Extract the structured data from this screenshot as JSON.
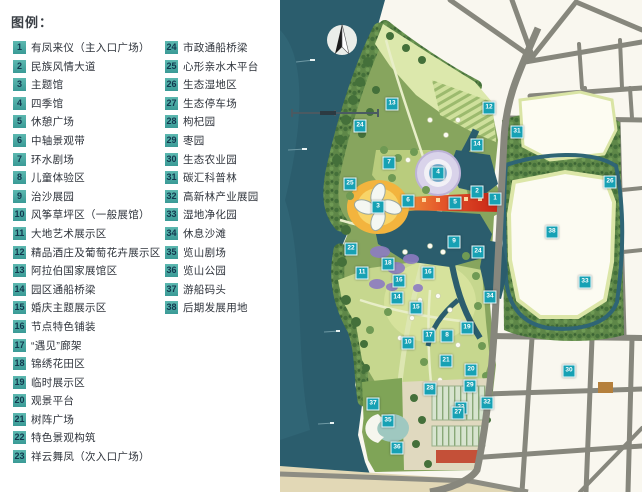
{
  "legend": {
    "title": "图例：",
    "items": [
      {
        "num": "1",
        "label": "有凤来仪（主入口广场）"
      },
      {
        "num": "2",
        "label": "民族风情大道"
      },
      {
        "num": "3",
        "label": "主题馆"
      },
      {
        "num": "4",
        "label": "四季馆"
      },
      {
        "num": "5",
        "label": "休憩广场"
      },
      {
        "num": "6",
        "label": "中轴景观带"
      },
      {
        "num": "7",
        "label": "环水剧场"
      },
      {
        "num": "8",
        "label": "儿童体验区"
      },
      {
        "num": "9",
        "label": "治沙展园"
      },
      {
        "num": "10",
        "label": "风筝草坪区（一般展馆）"
      },
      {
        "num": "11",
        "label": "大地艺术展示区"
      },
      {
        "num": "12",
        "label": "精品酒庄及葡萄花卉展示区"
      },
      {
        "num": "13",
        "label": "阿拉伯国家展馆区"
      },
      {
        "num": "14",
        "label": "园区通船桥梁"
      },
      {
        "num": "15",
        "label": "婚庆主题展示区"
      },
      {
        "num": "16",
        "label": "节点特色铺装"
      },
      {
        "num": "17",
        "label": "“遇见”廊架"
      },
      {
        "num": "18",
        "label": "锦绣花田区"
      },
      {
        "num": "19",
        "label": "临时展示区"
      },
      {
        "num": "20",
        "label": "观景平台"
      },
      {
        "num": "21",
        "label": "树阵广场"
      },
      {
        "num": "22",
        "label": "特色景观构筑"
      },
      {
        "num": "23",
        "label": "祥云舞凤（次入口广场）"
      },
      {
        "num": "24",
        "label": "市政通船桥梁"
      },
      {
        "num": "25",
        "label": "心形亲水木平台"
      },
      {
        "num": "26",
        "label": "生态湿地区"
      },
      {
        "num": "27",
        "label": "生态停车场"
      },
      {
        "num": "28",
        "label": "枸杞园"
      },
      {
        "num": "29",
        "label": "枣园"
      },
      {
        "num": "30",
        "label": "生态农业园"
      },
      {
        "num": "31",
        "label": "碳汇科普林"
      },
      {
        "num": "32",
        "label": "高新林产业展园"
      },
      {
        "num": "33",
        "label": "湿地净化园"
      },
      {
        "num": "34",
        "label": "休息沙滩"
      },
      {
        "num": "35",
        "label": "览山剧场"
      },
      {
        "num": "36",
        "label": "览山公园"
      },
      {
        "num": "37",
        "label": "游船码头"
      },
      {
        "num": "38",
        "label": "后期发展用地"
      }
    ]
  },
  "map": {
    "icons": {
      "compass": "north-arrow-icon",
      "scale": "scale-bar"
    },
    "colors": {
      "marker_teal": "#17a1b4",
      "legend_square_teal": "#3a9a96",
      "water": "#2b5d6d",
      "axis_red": "#cf2a1c",
      "park_green": "#87a55e",
      "road_gray": "#87877d",
      "sand": "#e2d8b6"
    },
    "markers": [
      {
        "n": "1",
        "x": 215,
        "y": 199
      },
      {
        "n": "2",
        "x": 197,
        "y": 192
      },
      {
        "n": "3",
        "x": 98,
        "y": 207
      },
      {
        "n": "4",
        "x": 158,
        "y": 173
      },
      {
        "n": "5",
        "x": 175,
        "y": 203
      },
      {
        "n": "6",
        "x": 128,
        "y": 201
      },
      {
        "n": "7",
        "x": 109,
        "y": 163
      },
      {
        "n": "8",
        "x": 167,
        "y": 336
      },
      {
        "n": "9",
        "x": 174,
        "y": 242
      },
      {
        "n": "10",
        "x": 128,
        "y": 343
      },
      {
        "n": "11",
        "x": 82,
        "y": 273
      },
      {
        "n": "12",
        "x": 209,
        "y": 108
      },
      {
        "n": "13",
        "x": 112,
        "y": 104
      },
      {
        "n": "14",
        "x": 197,
        "y": 145
      },
      {
        "n": "14",
        "x": 117,
        "y": 298
      },
      {
        "n": "15",
        "x": 136,
        "y": 308
      },
      {
        "n": "16",
        "x": 119,
        "y": 281
      },
      {
        "n": "16",
        "x": 148,
        "y": 273
      },
      {
        "n": "17",
        "x": 149,
        "y": 336
      },
      {
        "n": "18",
        "x": 108,
        "y": 264
      },
      {
        "n": "19",
        "x": 187,
        "y": 328
      },
      {
        "n": "20",
        "x": 191,
        "y": 370
      },
      {
        "n": "21",
        "x": 166,
        "y": 361
      },
      {
        "n": "22",
        "x": 71,
        "y": 249
      },
      {
        "n": "23",
        "x": 181,
        "y": 408
      },
      {
        "n": "24",
        "x": 80,
        "y": 126
      },
      {
        "n": "24",
        "x": 198,
        "y": 252
      },
      {
        "n": "25",
        "x": 70,
        "y": 184
      },
      {
        "n": "26",
        "x": 330,
        "y": 182
      },
      {
        "n": "27",
        "x": 178,
        "y": 413
      },
      {
        "n": "28",
        "x": 150,
        "y": 389
      },
      {
        "n": "29",
        "x": 190,
        "y": 386
      },
      {
        "n": "30",
        "x": 289,
        "y": 371
      },
      {
        "n": "31",
        "x": 237,
        "y": 132
      },
      {
        "n": "32",
        "x": 207,
        "y": 403
      },
      {
        "n": "33",
        "x": 305,
        "y": 282
      },
      {
        "n": "34",
        "x": 210,
        "y": 297
      },
      {
        "n": "35",
        "x": 108,
        "y": 421
      },
      {
        "n": "36",
        "x": 117,
        "y": 448
      },
      {
        "n": "37",
        "x": 93,
        "y": 404
      },
      {
        "n": "38",
        "x": 272,
        "y": 232
      }
    ]
  }
}
